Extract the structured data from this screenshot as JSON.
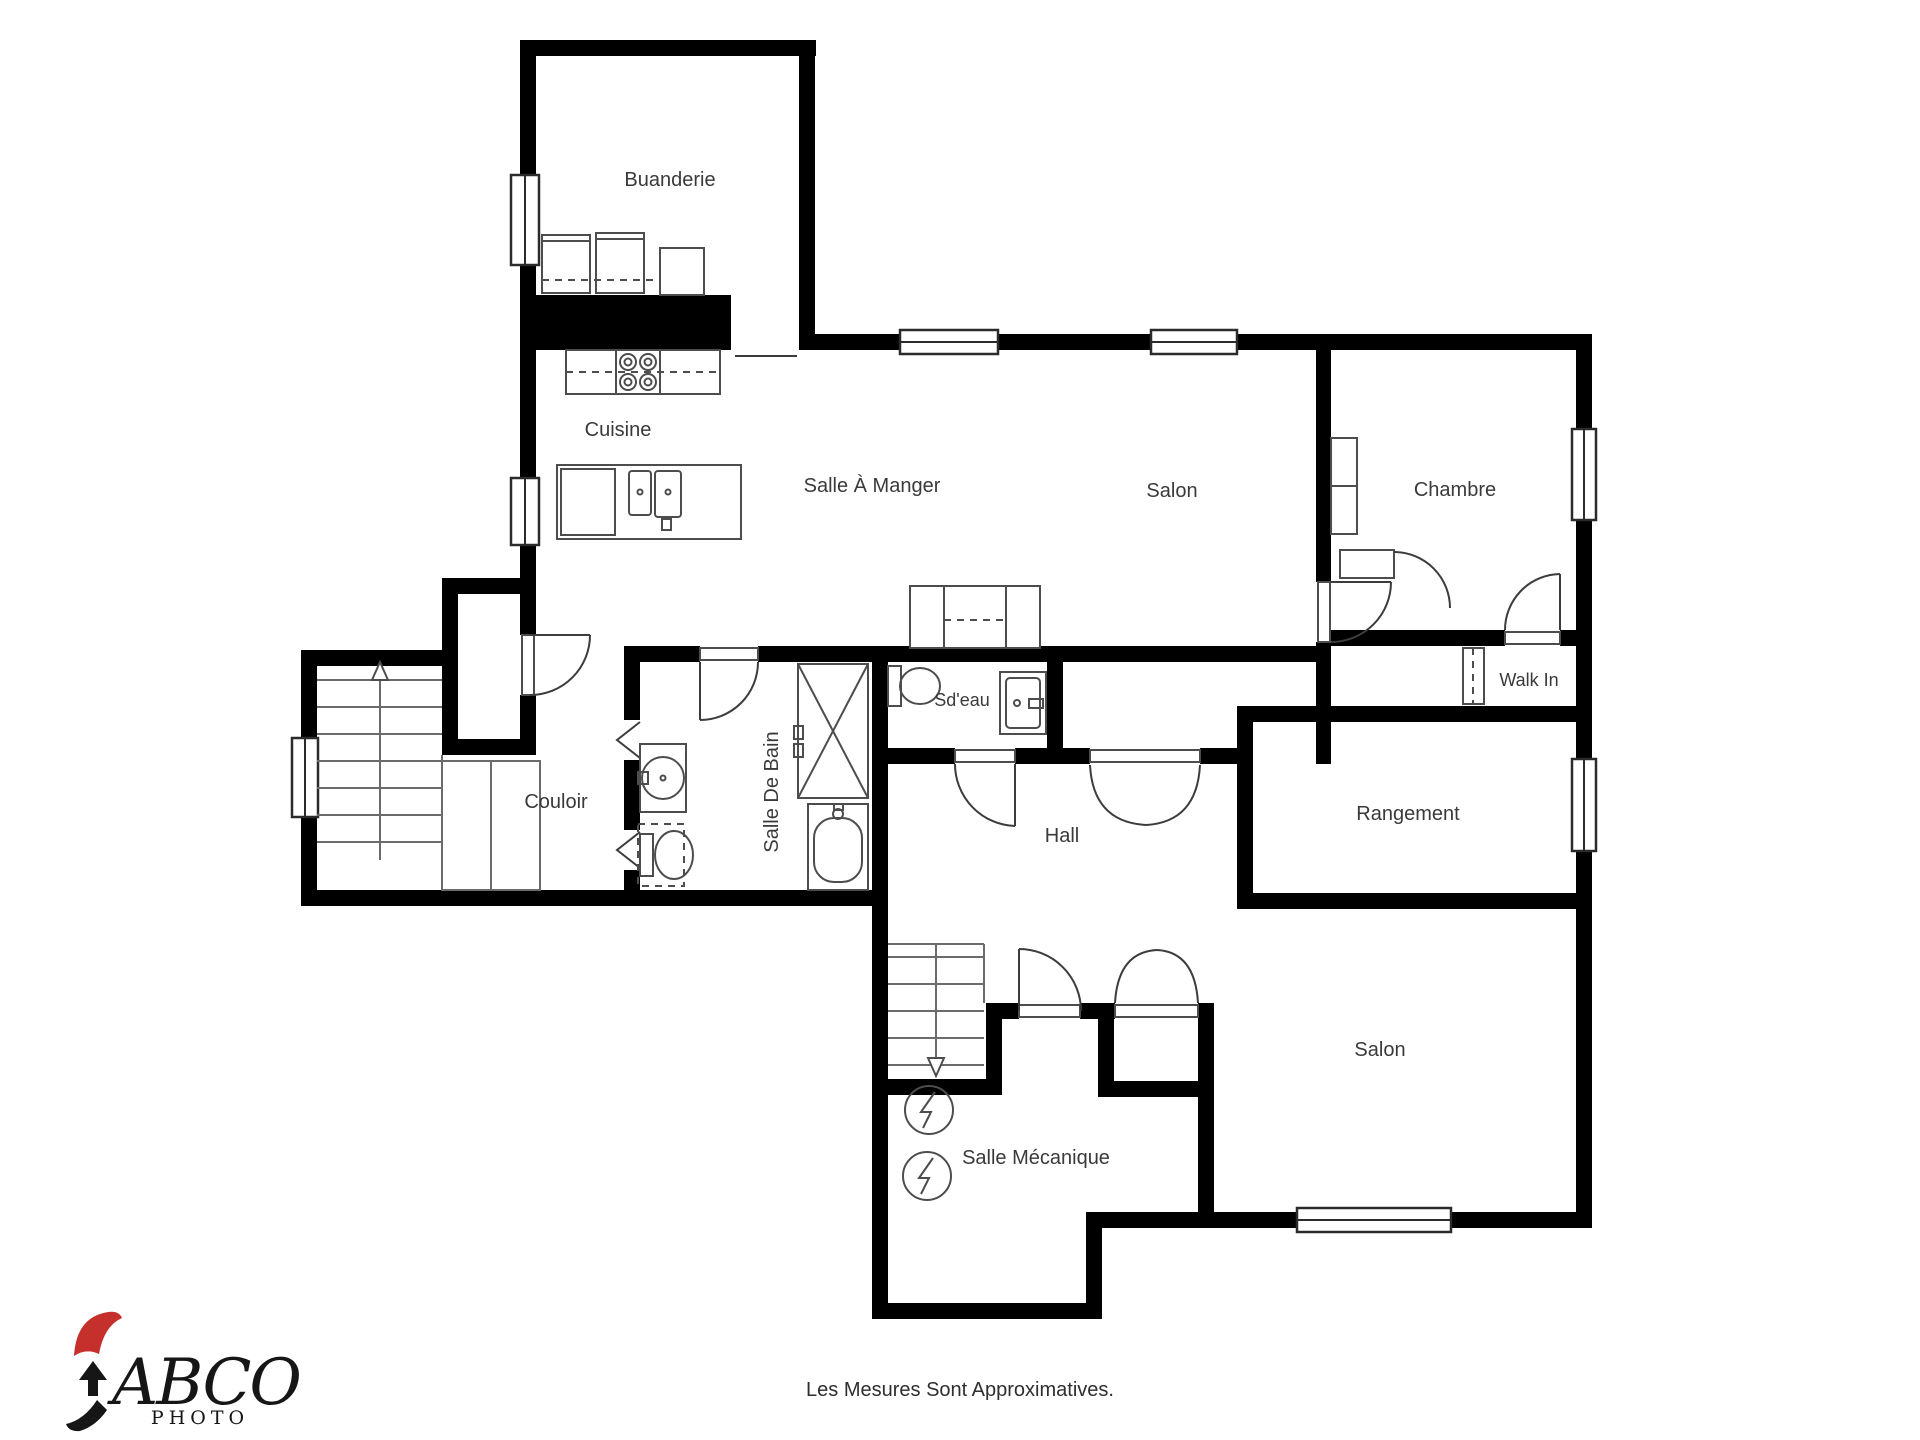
{
  "colors": {
    "wall": "#000000",
    "accent": "#c6302c",
    "line": "#4d4d4d",
    "text": "#3a3a3a"
  },
  "rooms": [
    {
      "id": "buanderie",
      "label": "Buanderie"
    },
    {
      "id": "cuisine",
      "label": "Cuisine"
    },
    {
      "id": "salle-a-manger",
      "label": "Salle À Manger"
    },
    {
      "id": "salon-haut",
      "label": "Salon"
    },
    {
      "id": "chambre",
      "label": "Chambre"
    },
    {
      "id": "sdeau",
      "label": "Sd'eau"
    },
    {
      "id": "walk-in",
      "label": "Walk In"
    },
    {
      "id": "couloir",
      "label": "Couloir"
    },
    {
      "id": "salle-de-bain",
      "label": "Salle De Bain"
    },
    {
      "id": "hall",
      "label": "Hall"
    },
    {
      "id": "rangement",
      "label": "Rangement"
    },
    {
      "id": "salle-mecanique",
      "label": "Salle Mécanique"
    },
    {
      "id": "salon-bas",
      "label": "Salon"
    }
  ],
  "footer": {
    "disclaimer": "Les Mesures Sont Approximatives."
  },
  "logo": {
    "name": "ABCO",
    "sub": "PHOTO"
  }
}
